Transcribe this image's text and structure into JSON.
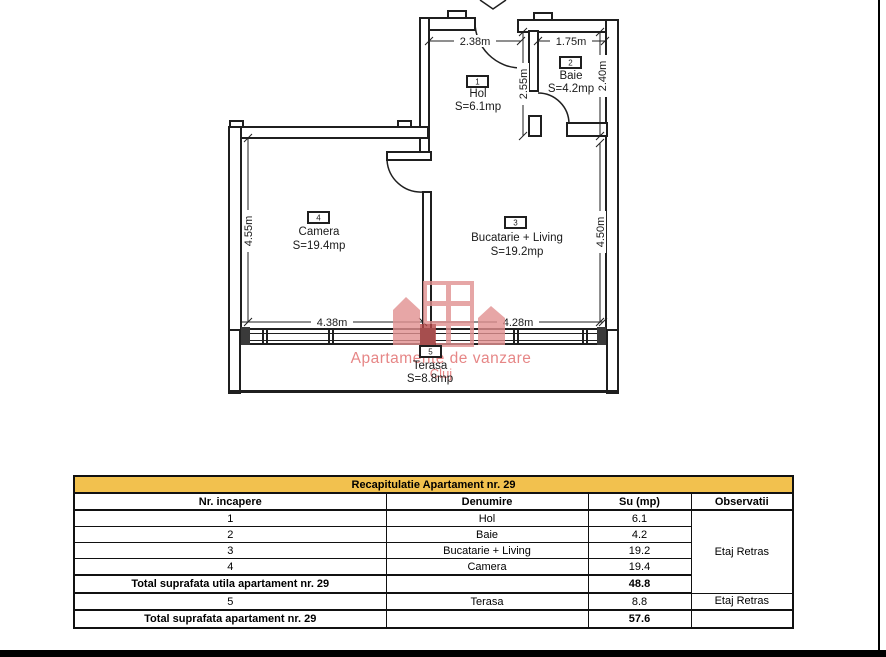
{
  "page": {
    "bg": "#ffffff",
    "frame_color": "#000000"
  },
  "plan": {
    "rooms": [
      {
        "number": "1",
        "name": "Hol",
        "area": "S=6.1mp"
      },
      {
        "number": "2",
        "name": "Baie",
        "area": "S=4.2mp"
      },
      {
        "number": "3",
        "name": "Bucatarie + Living",
        "area": "S=19.2mp"
      },
      {
        "number": "4",
        "name": "Camera",
        "area": "S=19.4mp"
      },
      {
        "number": "5",
        "name": "Terasa",
        "area": "S=8.8mp"
      }
    ],
    "dims": {
      "hol_width": "2.38m",
      "baie_width": "1.75m",
      "hol_depth": "2.55m",
      "baie_depth": "2.40m",
      "camera_depth": "4.55m",
      "living_depth": "4.50m",
      "camera_width": "4.38m",
      "living_width": "4.28m"
    },
    "watermark": {
      "line1": "Apartamente de vanzare",
      "line2": "Cluj",
      "color": "#e06868"
    }
  },
  "table": {
    "title": "Recapitulatie Apartament nr. 29",
    "title_bg": "#f2c14e",
    "headers": {
      "nr": "Nr. incapere",
      "denumire": "Denumire",
      "su": "Su (mp)",
      "obs": "Observatii"
    },
    "rows": [
      {
        "nr": "1",
        "denumire": "Hol",
        "su": "6.1"
      },
      {
        "nr": "2",
        "denumire": "Baie",
        "su": "4.2"
      },
      {
        "nr": "3",
        "denumire": "Bucatarie + Living",
        "su": "19.2"
      },
      {
        "nr": "4",
        "denumire": "Camera",
        "su": "19.4"
      }
    ],
    "merged_observatii": "Etaj Retras",
    "total_utila": {
      "label": "Total suprafata utila apartament nr. 29",
      "su": "48.8"
    },
    "terasa_row": {
      "nr": "5",
      "denumire": "Terasa",
      "su": "8.8",
      "obs": "Etaj Retras"
    },
    "total": {
      "label": "Total suprafata apartament nr. 29",
      "su": "57.6"
    }
  }
}
